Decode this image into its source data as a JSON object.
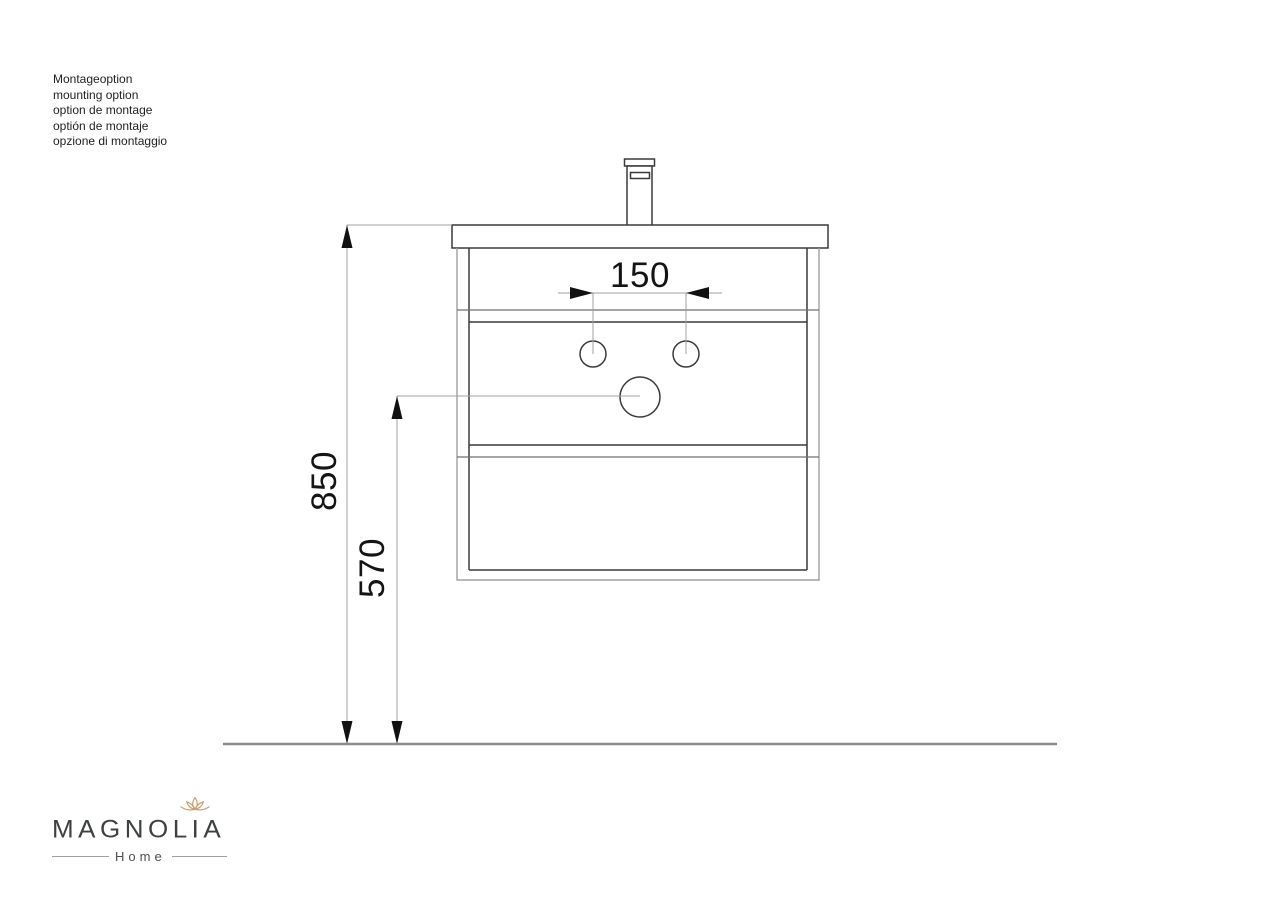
{
  "note": {
    "lines": [
      "Montageoption",
      "mounting option",
      "option de montage",
      "optión de montaje",
      "opzione di montaggio"
    ]
  },
  "drawing": {
    "dim_hole_spacing": "150",
    "dim_height_total": "850",
    "dim_height_drain": "570"
  },
  "logo": {
    "brand": "MAGNOLIA",
    "subtitle": "Home"
  },
  "colors": {
    "line_dark": "#3a3a3a",
    "line_light": "#a0a0a0",
    "arrow_black": "#111111",
    "ground_gray": "#8c8c8c",
    "note_text": "#1f1f1f",
    "dim_text": "#141414",
    "logo_text": "#3e4142",
    "logo_flower": "#c79c6e",
    "page_bg": "#ffffff"
  }
}
